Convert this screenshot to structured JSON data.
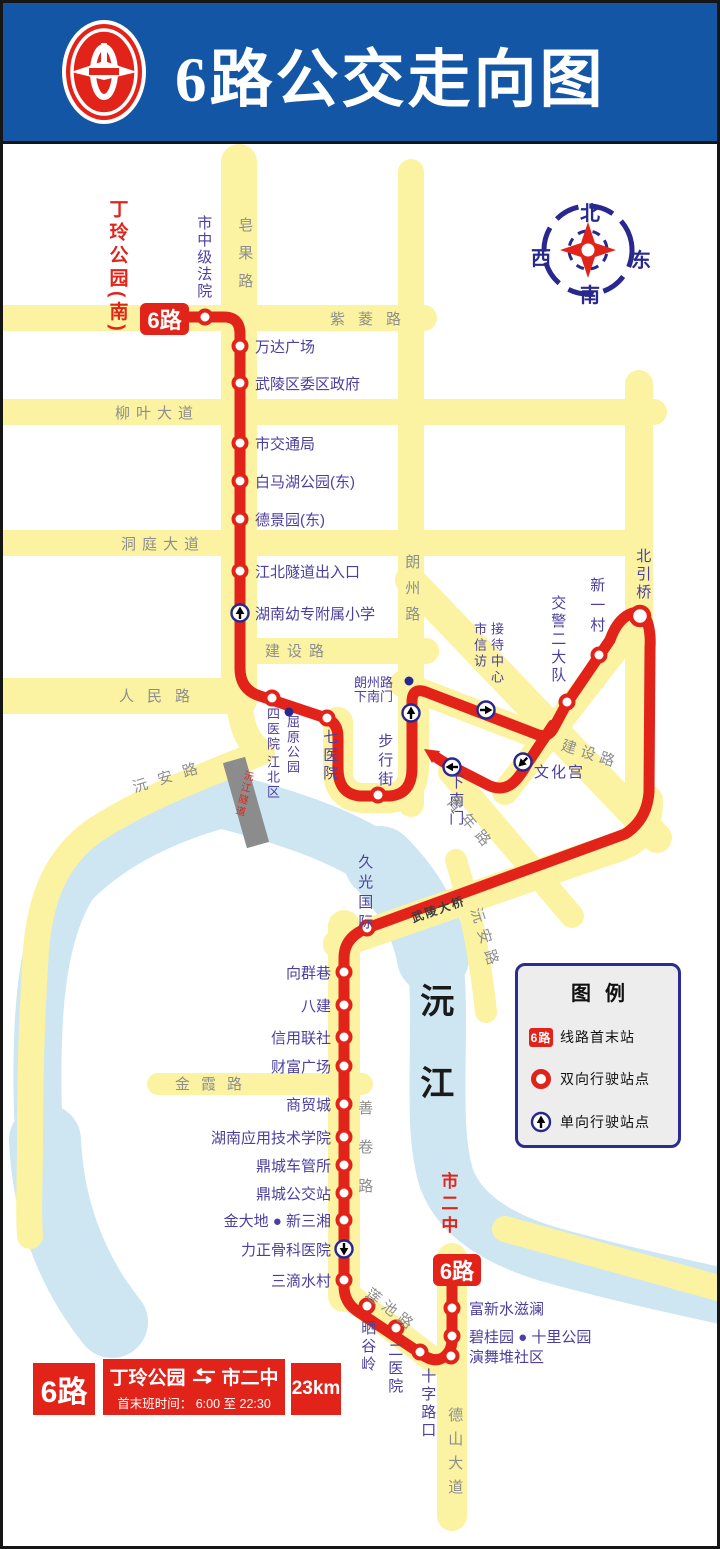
{
  "header": {
    "title": "6路公交走向图"
  },
  "compass": {
    "n": "北",
    "s": "南",
    "w": "西",
    "e": "东"
  },
  "badges": {
    "start": "6路",
    "end": "6路"
  },
  "terminals": {
    "start": "丁玲公园(南)",
    "end": "市二中"
  },
  "roads": {
    "ziling": "紫菱路",
    "zaoguo": "皂果路",
    "liuye": "柳叶大道",
    "dongting": "洞庭大道",
    "langzhou": "朗州路",
    "jianshe_w": "建设路",
    "jianshe_e": "建设路",
    "renmin": "人民路",
    "yuanan_w": "沅安路",
    "yuanan_e": "沅安路",
    "qingnian": "青年路",
    "jinxia": "金霞路",
    "shanjuan": "善卷路",
    "lianchi": "莲池路",
    "deshan": "德山大道",
    "beiyinqiao_rd": "北引桥",
    "wuling_bridge": "武陵大桥",
    "yuanjiang_tunnel": "沅江隧道"
  },
  "river": {
    "name": "沅江"
  },
  "stops": {
    "shi_zhongji_fayuan": "市中级法院",
    "wanda": "万达广场",
    "wuling_qu": "武陵区委区政府",
    "shi_jiaotong_ju": "市交通局",
    "baimahu": "白马湖公园(东)",
    "dejingyuan": "德景园(东)",
    "jiangbei_suidao": "江北隧道出入口",
    "hunan_youzhuan": "湖南幼专附属小学",
    "si_yiyuan": "四医院",
    "qi_yiyuan": "七医院",
    "buxingjie": "步行街",
    "jiaojing": "交警二大队",
    "xin_yi_cun": "新一村",
    "beiyinqiao": "北引桥",
    "wenhuagong": "文化宫",
    "xia_nanmen": "下南门",
    "jiuguang": "久光国际",
    "xiangqunxiang": "向群巷",
    "bajian": "八建",
    "xinyong_lianshe": "信用联社",
    "caifu_guangchang": "财富广场",
    "shangmaocheng": "商贸城",
    "hunan_yingyong": "湖南应用技术学院",
    "dingcheng_cheguansuo": "鼎城车管所",
    "dingcheng_gongjiaozhan": "鼎城公交站",
    "jindadi": "金大地 ● 新三湘",
    "lizheng": "力正骨科医院",
    "sandishuicun": "三滴水村",
    "shaiguling": "晒谷岭",
    "er_yiyuan": "二医院",
    "shizilukou": "十字路口",
    "fuxin": "富新水滋澜",
    "biguiyuan": "碧桂园 ● 十里公园",
    "yanwudui": "演舞堆社区"
  },
  "landmarks": {
    "langzhou_xiananmen_l1": "朗州路",
    "langzhou_xiananmen_l2": "下南门",
    "quyuan_col_r": "屈原公园",
    "quyuan_col_l": "江北区",
    "jiedai_col_l": "市信访",
    "jiedai_col_r": "接待中心"
  },
  "legend": {
    "title": "图例",
    "badge": "6路",
    "first_last": "线路首末站",
    "bidirectional": "双向行驶站点",
    "oneway": "单向行驶站点"
  },
  "info_bar": {
    "route": "6路",
    "from": "丁玲公园",
    "to": "市二中",
    "schedule_label": "首末班时间：",
    "schedule_value": "6:00 至 22:30",
    "distance": "23km"
  },
  "colors": {
    "route_red": "#E2231A",
    "road_yellow": "#FBF3A1",
    "river_blue": "#CDE6F2",
    "header_blue": "#1456A6"
  }
}
